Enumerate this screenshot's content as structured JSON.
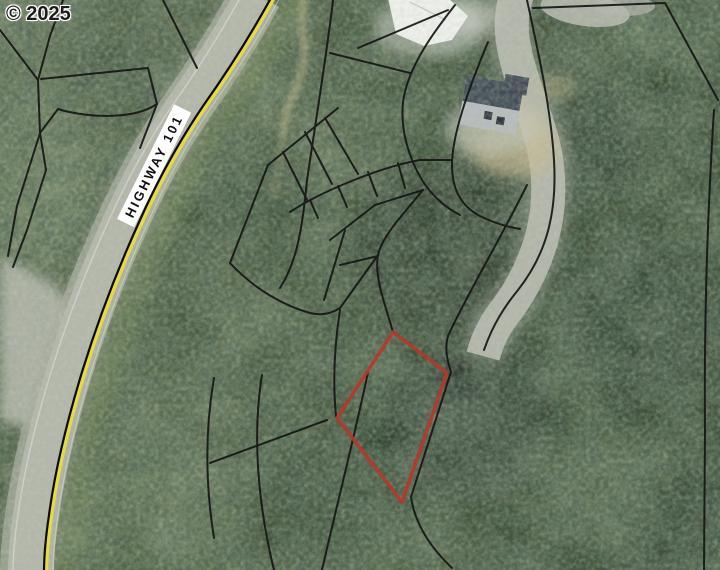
{
  "map": {
    "copyright": "© 2025",
    "road_label": "HIGHWAY 101"
  },
  "red_parcel": {
    "name": "subject parcel outline",
    "points": "393,332 447,373 402,502 337,418"
  },
  "colors": {
    "highlight_parcel": "#b5382b",
    "parcel_line": "#161616",
    "highway_centerline_black": "#0d0d0d",
    "highway_centerline_yellow": "#e9da3d",
    "road_surface": "#b2b5ab",
    "driveway_surface": "#b5b7af",
    "label_bg": "#ffffff",
    "label_text": "#111111",
    "copyright_text": "#1c1c1c",
    "forest_dark": "#1d2c20",
    "forest_light": "#6d7f5e",
    "dirt_tan": "#c6b98f"
  }
}
